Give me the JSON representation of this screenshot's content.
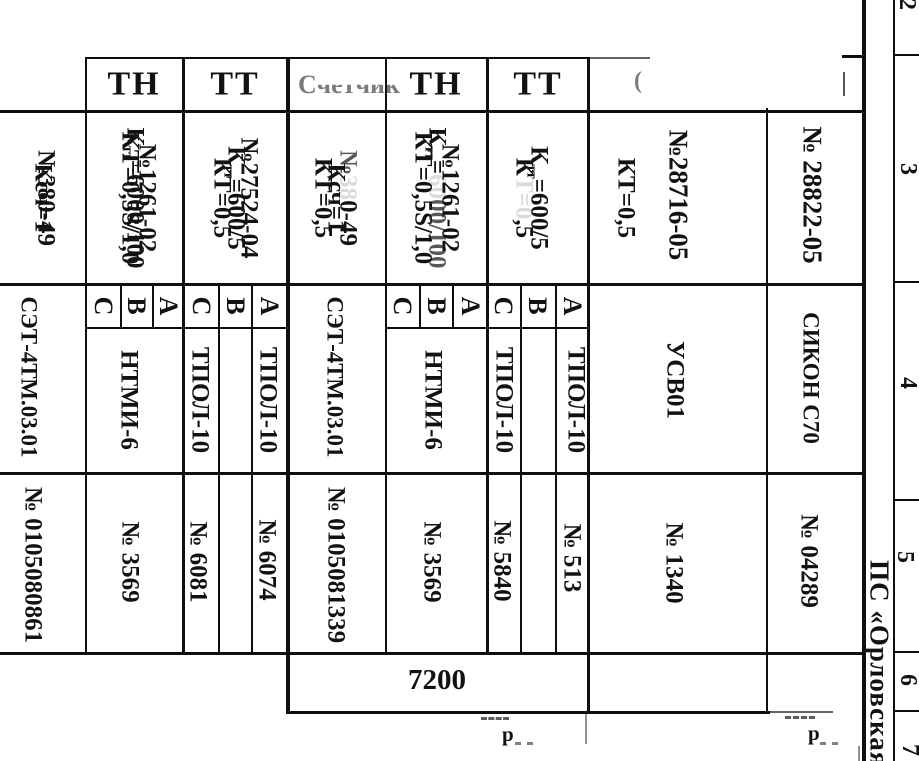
{
  "frame": {
    "station": "ПС «Орловская»",
    "zones": [
      "2",
      "3",
      "4",
      "5",
      "6",
      "7"
    ]
  },
  "headers": {
    "tn1": "ТН",
    "tt1": "ТТ",
    "meter2_first": "С",
    "meter2_rest": "четчик",
    "tn2": "ТН",
    "tt2": "ТТ"
  },
  "phases": {
    "a": "А",
    "b": "В",
    "c": "С"
  },
  "meter1": {
    "kt": "КТ=0,5S/1,0",
    "ksch": "Ксч=1",
    "cert": "№27524-04",
    "model": "СЭТ-4ТМ.03.01",
    "serial": "№ 0105080861"
  },
  "tn1": {
    "kt": "КТ=0,5",
    "k": "К",
    "k_sub": "тт",
    "k_rest": "=6000/100",
    "cert": "№380-49",
    "model": "НТМИ-6",
    "serial": "№ 3569"
  },
  "tt1": {
    "kt": "КТ=0,5",
    "k": "К",
    "k_sub": "тт",
    "k_rest": "=600/5",
    "cert": "№1261-02",
    "model_c": "ТПОЛ-10",
    "model_a": "ТПОЛ-10",
    "serial_c": "№ 6081",
    "serial_a": "№ 6074"
  },
  "meter2": {
    "kt": "КТ=0,5S/1,0",
    "ksch": "Ксч=1",
    "cert": "№27524-04",
    "model": "СЭТ-4ТМ.03.01",
    "serial": "№ 0105081339"
  },
  "tn2": {
    "kt_1": "К",
    "kt_2": "Т=0",
    "kt_3": ",5",
    "k": "К",
    "k_sub": "тт",
    "k_eq": "=",
    "k_f1": "60",
    "k_f2": "00/100",
    "c_1": "№",
    "c_2": "38",
    "c_3": "0-49",
    "model": "НТМИ-6",
    "serial": "№ 3569"
  },
  "tt2": {
    "kt": "КТ=0,5",
    "k": "К",
    "k_sub": "тт",
    "k_rest": "=600/5",
    "cert": "№1261-02",
    "model_c": "ТПОЛ-10",
    "model_a": "ТПОЛ-10",
    "serial_c": "№ 5840",
    "serial_a": "№ 513"
  },
  "usv": {
    "reg": "№28716-05",
    "model": "УСВ01",
    "serial": "№ 1340"
  },
  "sikon": {
    "reg": "№ 28822-05",
    "model": "СИКОН С70",
    "serial": "№ 04289"
  },
  "dim": {
    "length": "7200"
  },
  "marks": {
    "paren": "(",
    "r1": "р",
    "r2": "р"
  }
}
